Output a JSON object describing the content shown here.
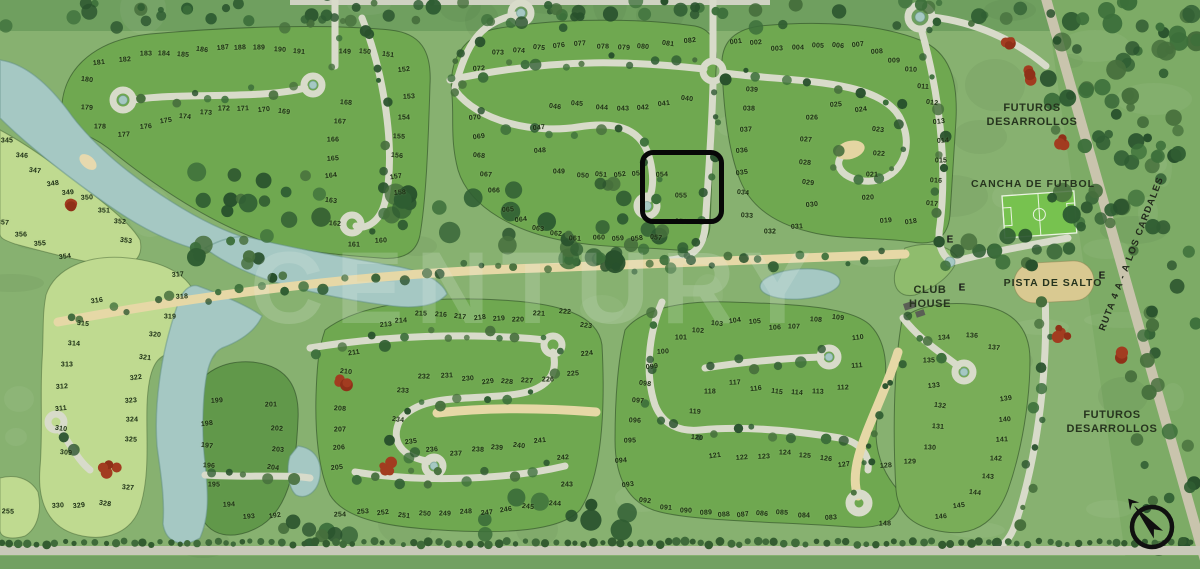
{
  "map_title": "Barrio privado - plano de lotes",
  "watermark": "CENTURY",
  "labels": {
    "futuros_top": {
      "line1": "FUTUROS",
      "line2": "DESARROLLOS"
    },
    "futuros_bottom": {
      "line1": "FUTUROS",
      "line2": "DESARROLLOS"
    },
    "cancha": "CANCHA DE FUTBOL",
    "pista": "PISTA DE SALTO",
    "club_house": {
      "line1": "CLUB",
      "line2": "HOUSE"
    },
    "ruta": "RUTA 4 A - A LOS CARDALES"
  },
  "highlight": {
    "lots": [
      "054",
      "055"
    ],
    "x": 640,
    "y": 150,
    "width": 74,
    "height": 64
  },
  "entrance_markers": [
    {
      "label": "E",
      "x": 950,
      "y": 240
    },
    {
      "label": "E",
      "x": 962,
      "y": 288
    },
    {
      "label": "E",
      "x": 1102,
      "y": 276
    }
  ],
  "compass": {
    "x": 1152,
    "y": 527
  },
  "colors": {
    "water": "#a5c8c3",
    "lot_green": "#6fa850",
    "lot_light": "#bfda90",
    "grass": "#87b170",
    "forest": "#7dab66",
    "road": "#d8dbca",
    "sandy_road": "#e6d8a6",
    "highlight_stroke": "#070707",
    "field_green": "#77c24f",
    "pista_tan": "#d9c991",
    "red_bush": "#a23c20"
  },
  "lots": [
    [
      "001",
      736,
      42
    ],
    [
      "002",
      756,
      43
    ],
    [
      "003",
      777,
      49
    ],
    [
      "004",
      798,
      48
    ],
    [
      "005",
      818,
      46
    ],
    [
      "006",
      838,
      46
    ],
    [
      "007",
      858,
      45
    ],
    [
      "008",
      877,
      52
    ],
    [
      "009",
      894,
      61
    ],
    [
      "010",
      911,
      70
    ],
    [
      "011",
      923,
      87
    ],
    [
      "012",
      932,
      103
    ],
    [
      "013",
      939,
      122
    ],
    [
      "014",
      943,
      141
    ],
    [
      "015",
      941,
      161
    ],
    [
      "016",
      936,
      181
    ],
    [
      "017",
      932,
      204
    ],
    [
      "018",
      911,
      222
    ],
    [
      "019",
      886,
      221
    ],
    [
      "020",
      868,
      198
    ],
    [
      "021",
      872,
      175
    ],
    [
      "022",
      879,
      154
    ],
    [
      "023",
      878,
      130
    ],
    [
      "024",
      861,
      110
    ],
    [
      "025",
      836,
      105
    ],
    [
      "026",
      812,
      118
    ],
    [
      "027",
      806,
      140
    ],
    [
      "028",
      805,
      163
    ],
    [
      "029",
      808,
      183
    ],
    [
      "030",
      812,
      205
    ],
    [
      "031",
      797,
      227
    ],
    [
      "032",
      770,
      232
    ],
    [
      "033",
      747,
      216
    ],
    [
      "034",
      743,
      193
    ],
    [
      "035",
      742,
      173
    ],
    [
      "036",
      742,
      151
    ],
    [
      "037",
      746,
      130
    ],
    [
      "038",
      749,
      109
    ],
    [
      "039",
      752,
      90
    ],
    [
      "040",
      687,
      99
    ],
    [
      "041",
      664,
      104
    ],
    [
      "042",
      643,
      108
    ],
    [
      "043",
      623,
      109
    ],
    [
      "044",
      602,
      108
    ],
    [
      "045",
      577,
      104
    ],
    [
      "046",
      555,
      107
    ],
    [
      "047",
      539,
      128
    ],
    [
      "048",
      540,
      151
    ],
    [
      "049",
      559,
      172
    ],
    [
      "050",
      583,
      176
    ],
    [
      "051",
      601,
      175
    ],
    [
      "052",
      620,
      175
    ],
    [
      "053",
      638,
      174
    ],
    [
      "054",
      662,
      175
    ],
    [
      "055",
      681,
      196
    ],
    [
      "056",
      681,
      222
    ],
    [
      "057",
      656,
      238
    ],
    [
      "058",
      637,
      239
    ],
    [
      "059",
      618,
      239
    ],
    [
      "060",
      599,
      238
    ],
    [
      "061",
      575,
      239
    ],
    [
      "062",
      556,
      234
    ],
    [
      "063",
      538,
      229
    ],
    [
      "064",
      521,
      220
    ],
    [
      "065",
      508,
      210
    ],
    [
      "066",
      494,
      191
    ],
    [
      "067",
      486,
      175
    ],
    [
      "068",
      479,
      156
    ],
    [
      "069",
      479,
      137
    ],
    [
      "070",
      475,
      118
    ],
    [
      "072",
      479,
      69
    ],
    [
      "073",
      498,
      53
    ],
    [
      "074",
      519,
      51
    ],
    [
      "075",
      539,
      48
    ],
    [
      "076",
      559,
      46
    ],
    [
      "077",
      580,
      44
    ],
    [
      "078",
      603,
      47
    ],
    [
      "079",
      624,
      48
    ],
    [
      "080",
      643,
      47
    ],
    [
      "081",
      668,
      44
    ],
    [
      "082",
      690,
      41
    ],
    [
      "083",
      831,
      518
    ],
    [
      "084",
      804,
      516
    ],
    [
      "085",
      782,
      513
    ],
    [
      "086",
      762,
      514
    ],
    [
      "087",
      743,
      515
    ],
    [
      "088",
      724,
      515
    ],
    [
      "089",
      706,
      513
    ],
    [
      "090",
      686,
      511
    ],
    [
      "091",
      666,
      508
    ],
    [
      "092",
      645,
      501
    ],
    [
      "093",
      628,
      485
    ],
    [
      "094",
      621,
      461
    ],
    [
      "095",
      630,
      441
    ],
    [
      "096",
      635,
      421
    ],
    [
      "097",
      638,
      401
    ],
    [
      "098",
      645,
      384
    ],
    [
      "099",
      652,
      367
    ],
    [
      "100",
      663,
      352
    ],
    [
      "101",
      681,
      338
    ],
    [
      "102",
      698,
      331
    ],
    [
      "103",
      717,
      324
    ],
    [
      "104",
      735,
      321
    ],
    [
      "105",
      755,
      322
    ],
    [
      "106",
      775,
      328
    ],
    [
      "107",
      794,
      327
    ],
    [
      "108",
      816,
      320
    ],
    [
      "109",
      838,
      318
    ],
    [
      "110",
      858,
      338
    ],
    [
      "111",
      857,
      366
    ],
    [
      "112",
      843,
      388
    ],
    [
      "113",
      818,
      392
    ],
    [
      "114",
      797,
      393
    ],
    [
      "115",
      777,
      392
    ],
    [
      "116",
      756,
      389
    ],
    [
      "117",
      735,
      383
    ],
    [
      "118",
      710,
      392
    ],
    [
      "119",
      695,
      412
    ],
    [
      "120",
      697,
      438
    ],
    [
      "121",
      715,
      456
    ],
    [
      "122",
      742,
      458
    ],
    [
      "123",
      764,
      457
    ],
    [
      "124",
      785,
      453
    ],
    [
      "125",
      805,
      456
    ],
    [
      "126",
      826,
      459
    ],
    [
      "127",
      844,
      465
    ],
    [
      "128",
      886,
      466
    ],
    [
      "129",
      910,
      462
    ],
    [
      "130",
      930,
      448
    ],
    [
      "131",
      938,
      427
    ],
    [
      "132",
      940,
      406
    ],
    [
      "133",
      934,
      386
    ],
    [
      "134",
      944,
      338
    ],
    [
      "135",
      929,
      361
    ],
    [
      "136",
      972,
      336
    ],
    [
      "137",
      994,
      348
    ],
    [
      "139",
      1006,
      399
    ],
    [
      "140",
      1005,
      420
    ],
    [
      "141",
      1002,
      440
    ],
    [
      "142",
      996,
      459
    ],
    [
      "143",
      988,
      477
    ],
    [
      "144",
      975,
      493
    ],
    [
      "145",
      959,
      506
    ],
    [
      "146",
      941,
      517
    ],
    [
      "148",
      885,
      524
    ],
    [
      "149",
      345,
      52
    ],
    [
      "150",
      365,
      52
    ],
    [
      "151",
      388,
      55
    ],
    [
      "152",
      404,
      70
    ],
    [
      "153",
      409,
      97
    ],
    [
      "154",
      404,
      118
    ],
    [
      "155",
      399,
      137
    ],
    [
      "156",
      397,
      156
    ],
    [
      "157",
      396,
      177
    ],
    [
      "158",
      400,
      193
    ],
    [
      "160",
      381,
      241
    ],
    [
      "161",
      354,
      245
    ],
    [
      "162",
      335,
      224
    ],
    [
      "163",
      331,
      201
    ],
    [
      "164",
      331,
      176
    ],
    [
      "165",
      333,
      159
    ],
    [
      "166",
      333,
      140
    ],
    [
      "167",
      340,
      122
    ],
    [
      "168",
      346,
      103
    ],
    [
      "169",
      284,
      112
    ],
    [
      "170",
      264,
      110
    ],
    [
      "171",
      243,
      109
    ],
    [
      "172",
      224,
      109
    ],
    [
      "173",
      206,
      113
    ],
    [
      "174",
      185,
      117
    ],
    [
      "175",
      166,
      121
    ],
    [
      "176",
      146,
      127
    ],
    [
      "177",
      124,
      135
    ],
    [
      "178",
      100,
      127
    ],
    [
      "179",
      87,
      108
    ],
    [
      "180",
      87,
      80
    ],
    [
      "181",
      99,
      63
    ],
    [
      "182",
      125,
      60
    ],
    [
      "183",
      146,
      54
    ],
    [
      "184",
      164,
      54
    ],
    [
      "185",
      183,
      55
    ],
    [
      "186",
      202,
      50
    ],
    [
      "187",
      223,
      48
    ],
    [
      "188",
      240,
      48
    ],
    [
      "189",
      259,
      48
    ],
    [
      "190",
      280,
      50
    ],
    [
      "191",
      299,
      52
    ],
    [
      "192",
      275,
      516
    ],
    [
      "193",
      249,
      517
    ],
    [
      "194",
      229,
      505
    ],
    [
      "195",
      214,
      485
    ],
    [
      "196",
      209,
      466
    ],
    [
      "197",
      207,
      446
    ],
    [
      "198",
      207,
      424
    ],
    [
      "199",
      217,
      401
    ],
    [
      "201",
      271,
      405
    ],
    [
      "202",
      277,
      429
    ],
    [
      "203",
      278,
      450
    ],
    [
      "204",
      273,
      468
    ],
    [
      "205",
      337,
      468
    ],
    [
      "206",
      339,
      448
    ],
    [
      "207",
      340,
      430
    ],
    [
      "208",
      340,
      409
    ],
    [
      "210",
      346,
      372
    ],
    [
      "211",
      354,
      353
    ],
    [
      "213",
      386,
      325
    ],
    [
      "214",
      401,
      321
    ],
    [
      "215",
      421,
      314
    ],
    [
      "216",
      441,
      315
    ],
    [
      "217",
      460,
      317
    ],
    [
      "218",
      480,
      318
    ],
    [
      "219",
      499,
      319
    ],
    [
      "220",
      518,
      320
    ],
    [
      "221",
      539,
      314
    ],
    [
      "222",
      565,
      312
    ],
    [
      "223",
      586,
      326
    ],
    [
      "224",
      587,
      354
    ],
    [
      "225",
      573,
      374
    ],
    [
      "226",
      548,
      380
    ],
    [
      "227",
      527,
      381
    ],
    [
      "228",
      507,
      382
    ],
    [
      "229",
      488,
      382
    ],
    [
      "230",
      468,
      379
    ],
    [
      "231",
      447,
      376
    ],
    [
      "232",
      424,
      377
    ],
    [
      "233",
      403,
      391
    ],
    [
      "234",
      398,
      420
    ],
    [
      "235",
      411,
      442
    ],
    [
      "236",
      432,
      450
    ],
    [
      "237",
      456,
      454
    ],
    [
      "238",
      478,
      450
    ],
    [
      "239",
      497,
      448
    ],
    [
      "240",
      519,
      446
    ],
    [
      "241",
      540,
      441
    ],
    [
      "242",
      563,
      458
    ],
    [
      "243",
      567,
      485
    ],
    [
      "244",
      555,
      504
    ],
    [
      "245",
      528,
      507
    ],
    [
      "246",
      506,
      510
    ],
    [
      "247",
      487,
      513
    ],
    [
      "248",
      466,
      512
    ],
    [
      "249",
      445,
      514
    ],
    [
      "250",
      425,
      514
    ],
    [
      "251",
      404,
      516
    ],
    [
      "252",
      383,
      513
    ],
    [
      "253",
      363,
      512
    ],
    [
      "254",
      340,
      515
    ],
    [
      "255",
      8,
      512
    ],
    [
      "309",
      66,
      453
    ],
    [
      "310",
      61,
      429
    ],
    [
      "311",
      61,
      409
    ],
    [
      "312",
      62,
      387
    ],
    [
      "313",
      67,
      365
    ],
    [
      "314",
      74,
      344
    ],
    [
      "315",
      83,
      324
    ],
    [
      "316",
      97,
      301
    ],
    [
      "317",
      178,
      275
    ],
    [
      "318",
      182,
      297
    ],
    [
      "319",
      170,
      317
    ],
    [
      "320",
      155,
      335
    ],
    [
      "321",
      145,
      358
    ],
    [
      "322",
      136,
      378
    ],
    [
      "323",
      131,
      401
    ],
    [
      "324",
      132,
      420
    ],
    [
      "325",
      131,
      440
    ],
    [
      "327",
      128,
      488
    ],
    [
      "328",
      105,
      504
    ],
    [
      "329",
      79,
      506
    ],
    [
      "330",
      58,
      506
    ],
    [
      "345",
      7,
      141
    ],
    [
      "346",
      22,
      156
    ],
    [
      "347",
      35,
      171
    ],
    [
      "348",
      53,
      184
    ],
    [
      "349",
      68,
      193
    ],
    [
      "350",
      87,
      198
    ],
    [
      "351",
      104,
      211
    ],
    [
      "352",
      120,
      222
    ],
    [
      "353",
      126,
      241
    ],
    [
      "354",
      65,
      257
    ],
    [
      "355",
      40,
      244
    ],
    [
      "356",
      21,
      235
    ],
    [
      "357",
      3,
      223
    ]
  ]
}
